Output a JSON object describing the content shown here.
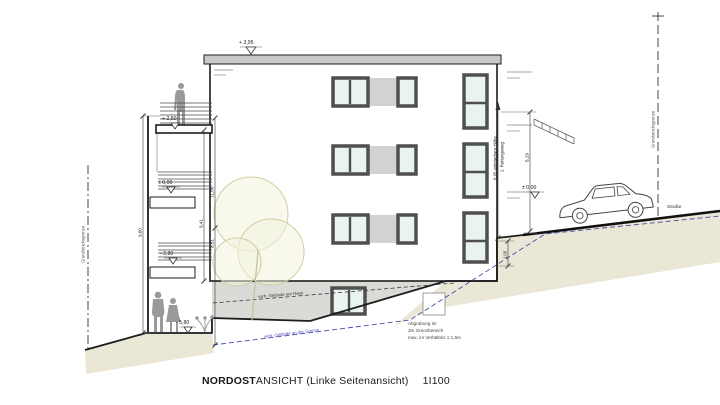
{
  "drawing": {
    "title": {
      "part_bold": "NORDOST",
      "part_rest": "ANSICHT (Linke Seitenansicht)",
      "scale": "1I100"
    },
    "boundary_left": "Grundstücksgrenze",
    "boundary_right": "Grundstücksgrenze",
    "street": "Straße",
    "levels": {
      "roof": "+ 3,95",
      "balcony": "+ 2,50",
      "zero_left": "± 0,00",
      "zero_right": "± 0,00",
      "minus_280": "- 2,80",
      "minus_580": "- 5,80"
    },
    "dims": {
      "outer_left": "9,60",
      "total_left": "11,56",
      "mid_left": "9,41",
      "low_left": "8,51",
      "right_total": "8,29",
      "right_step": "1,00",
      "rescue_height": "6,95  anleiterbare Höhe",
      "rescue_label": "2. Rettungsweg"
    },
    "grades": {
      "at_house": "vorh. Gelände am Haus",
      "at_boundary": "vorh. Gelände an der Grenze"
    },
    "excavation_note": {
      "line1": "Abgrabung im",
      "line2": "3m Grenzbereich",
      "line3": "max. im Verhältnis 1:1,5m"
    },
    "colors": {
      "terrain_tan": "#ebe7d6",
      "terrain_gray": "#dadad7",
      "glass": "#e9f4f2",
      "frame": "#4f4f4f",
      "panel": "#d2d2d2",
      "slab_gray": "#c9c9c9",
      "tree_fill": "#f3f3de",
      "tree_stroke": "#cfcfa2",
      "grade_blue": "#4a4ab0",
      "figure_gray": "#9a9a9a"
    }
  }
}
